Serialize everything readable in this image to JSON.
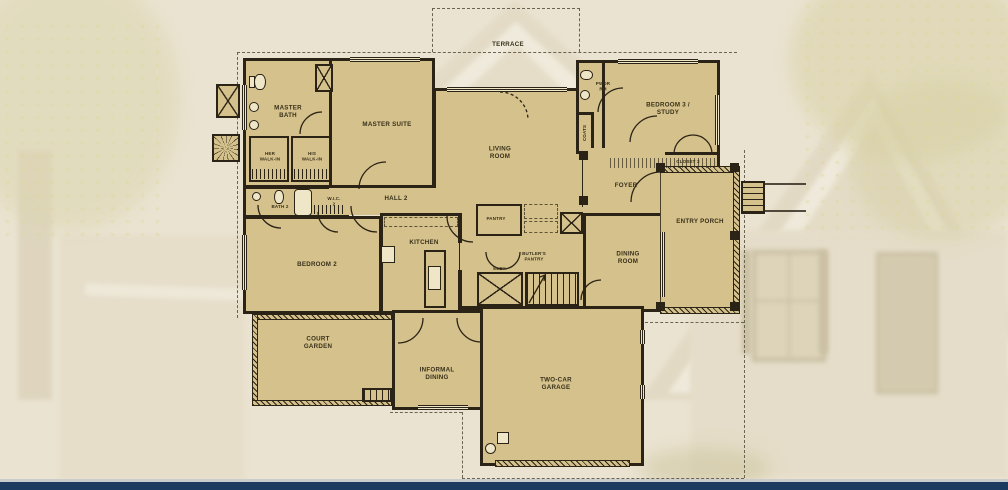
{
  "theme": {
    "background": "#eae3d1",
    "plan_fill": "#d5c18b",
    "wall_color": "#2b2316",
    "label_color": "#38301a",
    "dashed_line_color": "#6b6352",
    "window_fill": "#efe6c8",
    "footer_bar_color": "#1c3a5f",
    "footer_line_color": "#c9cccb"
  },
  "plan": {
    "labels": {
      "terrace": "TERRACE",
      "master_bath": "MASTER\nBATH",
      "master_suite": "MASTER SUITE",
      "her_walk_in": "HER\nWALK-IN",
      "his_walk_in": "HIS\nWALK-IN",
      "bath_2": "BATH 2",
      "wic_2": "W.I.C.\n2",
      "hall_2": "HALL 2",
      "bedroom_2": "BEDROOM 2",
      "kitchen": "KITCHEN",
      "pantry": "PANTRY",
      "butlers_pantry": "BUTLER'S\nPANTRY",
      "elev": "ELEV.",
      "living_room": "LIVING\nROOM",
      "pwdr_rm": "PWDR\nRM",
      "bedroom_3_study": "BEDROOM 3 /\nSTUDY",
      "coats": "COATS",
      "closet_3": "CLOSET 3",
      "foyer": "FOYER",
      "entry_porch": "ENTRY PORCH",
      "dining_room": "DINING\nROOM",
      "court_garden": "COURT\nGARDEN",
      "informal_dining": "INFORMAL\nDINING",
      "two_car_garage": "TWO-CAR\nGARAGE"
    }
  }
}
